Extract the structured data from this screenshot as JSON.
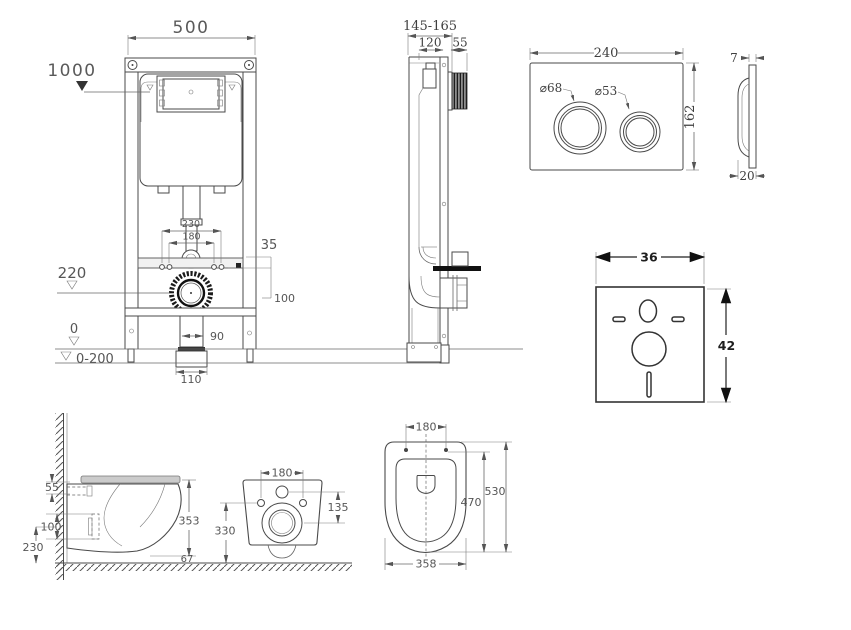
{
  "views": {
    "frame_front": {
      "width": "500",
      "height_mark": "1000",
      "dim_230": "230",
      "dim_180": "180",
      "dim_35": "35",
      "dim_100": "100",
      "level_220": "220",
      "dim_90": "90",
      "dim_110": "110",
      "level_0": "0",
      "level_range": "0-200"
    },
    "frame_side": {
      "depth_range": "145-165",
      "dim_120": "120",
      "dim_55": "55"
    },
    "flush_plate": {
      "width": "240",
      "height": "162",
      "button_large": "⌀68",
      "button_small": "⌀53",
      "thickness": "7",
      "depth": "20"
    },
    "insulation_mat": {
      "width": "36",
      "height": "42"
    },
    "toilet_side": {
      "dim_55": "55",
      "dim_100": "100",
      "dim_230": "230",
      "dim_353": "353",
      "dim_67": "67"
    },
    "toilet_rear": {
      "dim_180": "180",
      "dim_135": "135",
      "dim_330": "330"
    },
    "toilet_top": {
      "dim_180": "180",
      "dim_470": "470",
      "dim_530": "530",
      "dim_358": "358"
    }
  }
}
